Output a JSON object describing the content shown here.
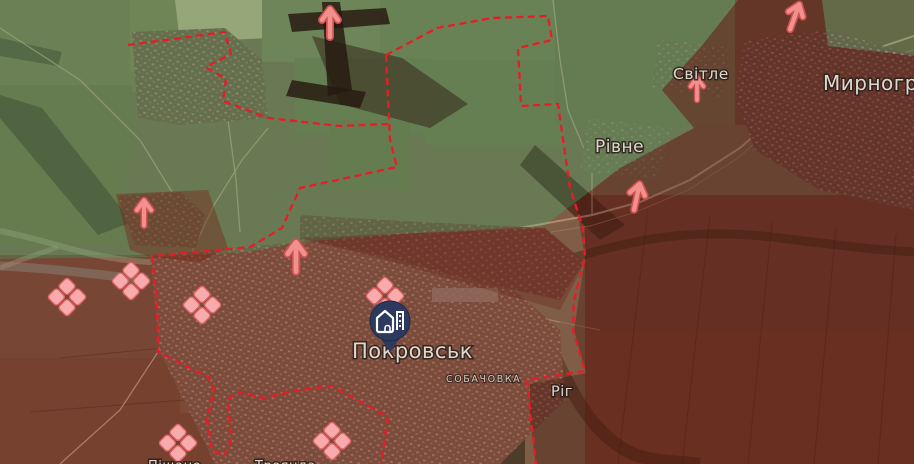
{
  "app": {
    "title": "Frontline situation map — Pokrovsk area"
  },
  "theme": {
    "frontline": "#e81c26",
    "arrow": "#f2908e",
    "arrow_edge": "#cc5150",
    "marker": "#f8abad",
    "marker_edge": "#dd6365",
    "pin": "#2d3a60",
    "friendly_zone": "rgba(88,126,74,0.42)",
    "occupied_zone": "rgba(92,18,10,0.50)",
    "contested_zone": "rgba(150,40,25,0.30)"
  },
  "map": {
    "labels": {
      "pokrovsk": "Покровськ",
      "sobachovka": "СОБАЧОВКА",
      "rih": "Ріг",
      "rivne": "Рівне",
      "svitle": "Світле",
      "myrnohrad": "Мирноград",
      "pishchane_partial": "Піщане",
      "troianda_partial": "Троянда"
    },
    "city_pin": {
      "city": "Покровськ",
      "x": 390,
      "y": 321,
      "icon": "city-buildings-icon"
    },
    "arrows": [
      {
        "x": 330,
        "y": 22,
        "rotate": 0,
        "scale": 1.0
      },
      {
        "x": 795,
        "y": 16,
        "rotate": 20,
        "scale": 0.95
      },
      {
        "x": 697,
        "y": 88,
        "rotate": 0,
        "scale": 0.8
      },
      {
        "x": 637,
        "y": 196,
        "rotate": 12,
        "scale": 0.95
      },
      {
        "x": 144,
        "y": 212,
        "rotate": 0,
        "scale": 0.9
      },
      {
        "x": 296,
        "y": 256,
        "rotate": 0,
        "scale": 1.05
      }
    ],
    "assault_markers": [
      {
        "x": 67,
        "y": 297
      },
      {
        "x": 131,
        "y": 281
      },
      {
        "x": 202,
        "y": 305
      },
      {
        "x": 385,
        "y": 296
      },
      {
        "x": 178,
        "y": 443
      },
      {
        "x": 332,
        "y": 441
      }
    ]
  }
}
